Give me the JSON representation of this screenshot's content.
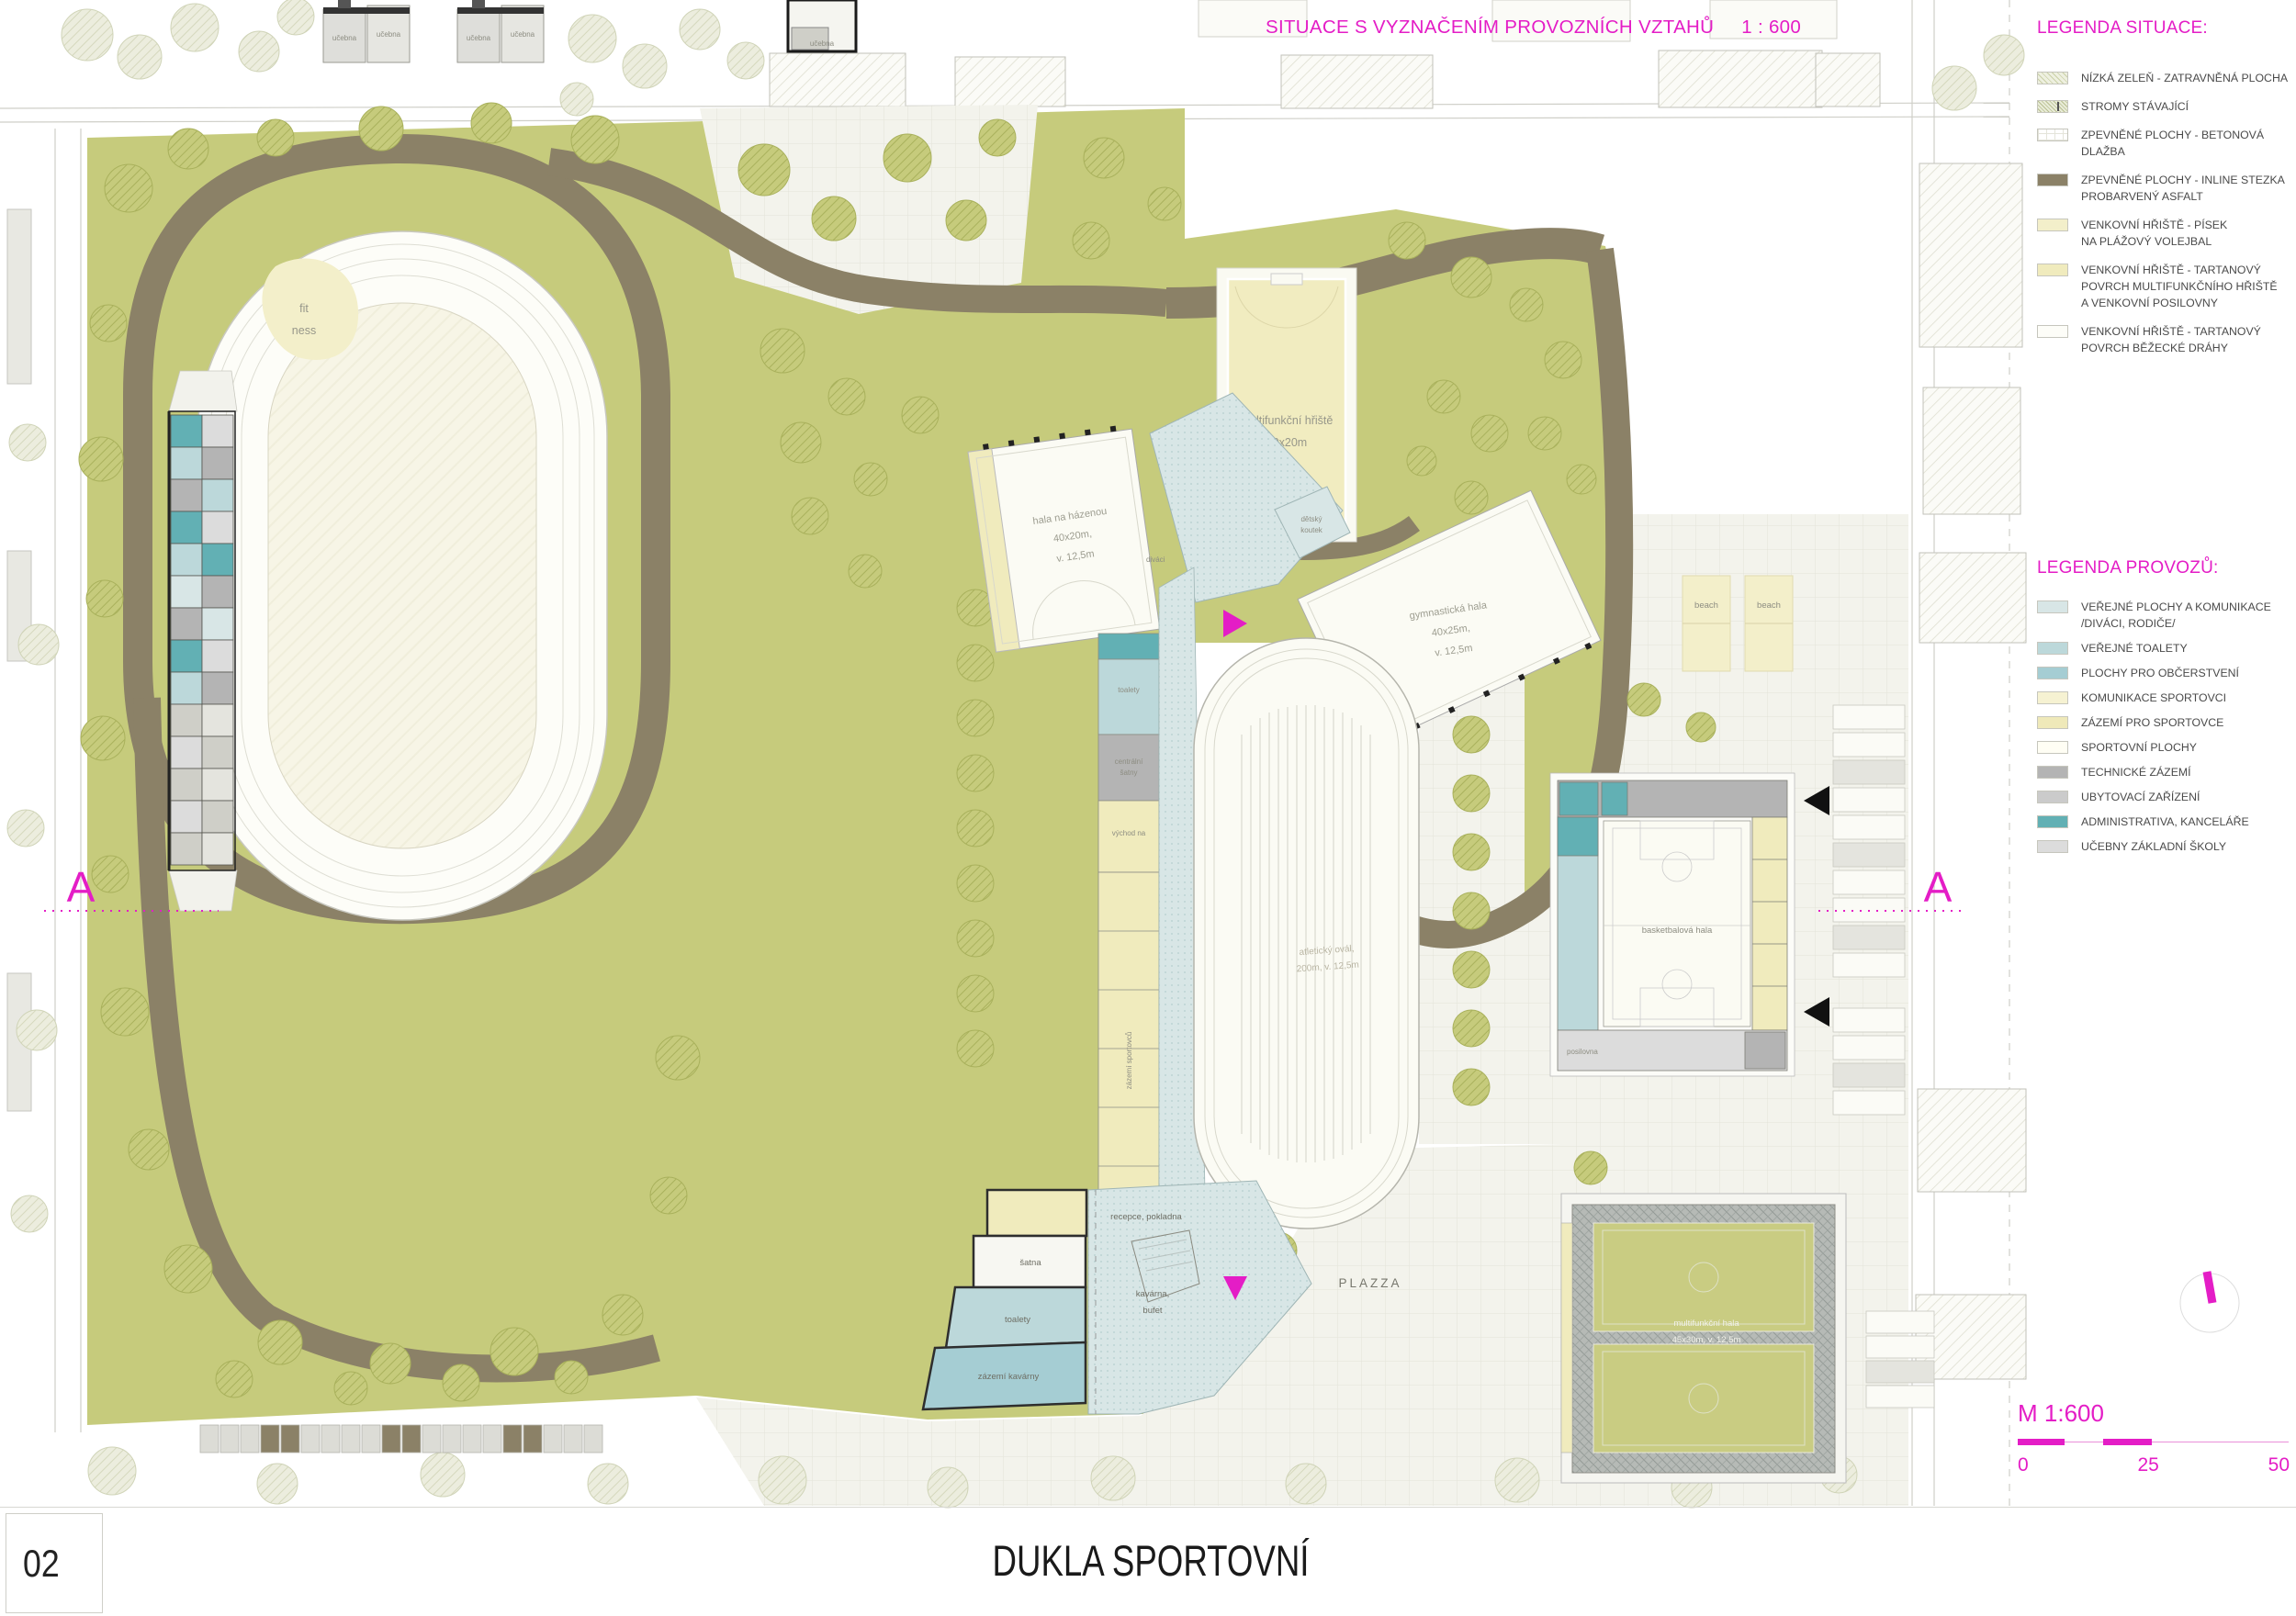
{
  "header": {
    "title": "SITUACE S VYZNAČENÍM PROVOZNÍCH VZTAHŮ",
    "scale": "1 :  600"
  },
  "legend_situace": {
    "title": "LEGENDA SITUACE:",
    "items": [
      {
        "label": "NÍZKÁ ZELEŇ - ZATRAVNĚNÁ PLOCHA",
        "color": "#eef0e0"
      },
      {
        "label": "STROMY STÁVAJÍCÍ",
        "color": "#e9ecd8"
      },
      {
        "label": "ZPEVNĚNÉ PLOCHY - BETONOVÁ\nDLAŽBA",
        "color": "#ffffff"
      },
      {
        "label": "ZPEVNĚNÉ PLOCHY - INLINE STEZKA\nPROBARVENÝ ASFALT",
        "color": "#8b8167"
      },
      {
        "label": "VENKOVNÍ HŘIŠTĚ - PÍSEK\nNA PLÁŽOVÝ VOLEJBAL",
        "color": "#f3efca"
      },
      {
        "label": "VENKOVNÍ HŘIŠTĚ - TARTANOVÝ\nPOVRCH MULTIFUNKČNÍHO HŘIŠTĚ\nA VENKOVNÍ POSILOVNY",
        "color": "#f0ebbd"
      },
      {
        "label": "VENKOVNÍ HŘIŠTĚ - TARTANOVÝ\nPOVRCH BĚŽECKÉ DRÁHY",
        "color": "#fdfdf8"
      }
    ]
  },
  "legend_provozu": {
    "title": "LEGENDA PROVOZŮ:",
    "items": [
      {
        "label": "VEŘEJNÉ PLOCHY  A KOMUNIKACE\n/DIVÁCI, RODIČE/",
        "color": "#d8e6e6"
      },
      {
        "label": "VEŘEJNÉ TOALETY",
        "color": "#bcd8da"
      },
      {
        "label": "PLOCHY PRO OBČERSTVENÍ",
        "color": "#a5cdd3"
      },
      {
        "label": "KOMUNIKACE SPORTOVCI",
        "color": "#f6f2d2"
      },
      {
        "label": "ZÁZEMÍ PRO SPORTOVCE",
        "color": "#efe9b9"
      },
      {
        "label": "SPORTOVNÍ PLOCHY",
        "color": "#fffef4"
      },
      {
        "label": "TECHNICKÉ ZÁZEMÍ",
        "color": "#b4b4b4"
      },
      {
        "label": "UBYTOVACÍ ZAŘÍZENÍ",
        "color": "#cbcbcb"
      },
      {
        "label": "ADMINISTRATIVA, KANCELÁŘE",
        "color": "#62b0b4"
      },
      {
        "label": "UČEBNY ZÁKLADNÍ ŠKOLY",
        "color": "#dcdcdc"
      }
    ]
  },
  "scale_bar": {
    "label": "M 1:600",
    "tick0": "0",
    "tick25": "25",
    "tick50": "50"
  },
  "title_block": {
    "sheet_number": "02",
    "project_title": "DUKLA SPORTOVNÍ"
  },
  "plan": {
    "section_marker": "A",
    "labels": {
      "fit1": "fit",
      "fit2": "ness",
      "ucebna": "učebna",
      "mult_hriste": "multifunkční hřiště",
      "mult_hriste_size": "40x20m",
      "hazena1": "hala na házenou",
      "hazena2": "40x20m,",
      "hazena3": "v. 12,5m",
      "gym1": "gymnastická hala",
      "gym2": "40x25m,",
      "gym3": "v. 12,5m",
      "detsky1": "dětský",
      "detsky2": "koutek",
      "oval1": "atletický ovál,",
      "oval2": "200m, v. 12,5m",
      "beach": "beach",
      "divaci": "diváci",
      "toalety_strip": "toalety",
      "satny1": "centrální",
      "satny2": "šatny",
      "vychod": "východ na",
      "zazemi_sport": "zázemí sportovců",
      "recepce": "recepce, pokladna",
      "satna": "šatna",
      "toalety": "toalety",
      "kavarna1": "kavárna,",
      "kavarna2": "bufet",
      "zazemi_kav": "zázemí kavárny",
      "plazza": "PLAZZA",
      "bball": "basketbalová hala",
      "posilovna": "posilovna",
      "mhala1": "multifunkční hala",
      "mhala2": "45x30m, v. 12,5m"
    }
  },
  "colors": {
    "accent": "#e41dc6",
    "site_green": "#c6cb7c",
    "path_brown": "#8b8167"
  }
}
